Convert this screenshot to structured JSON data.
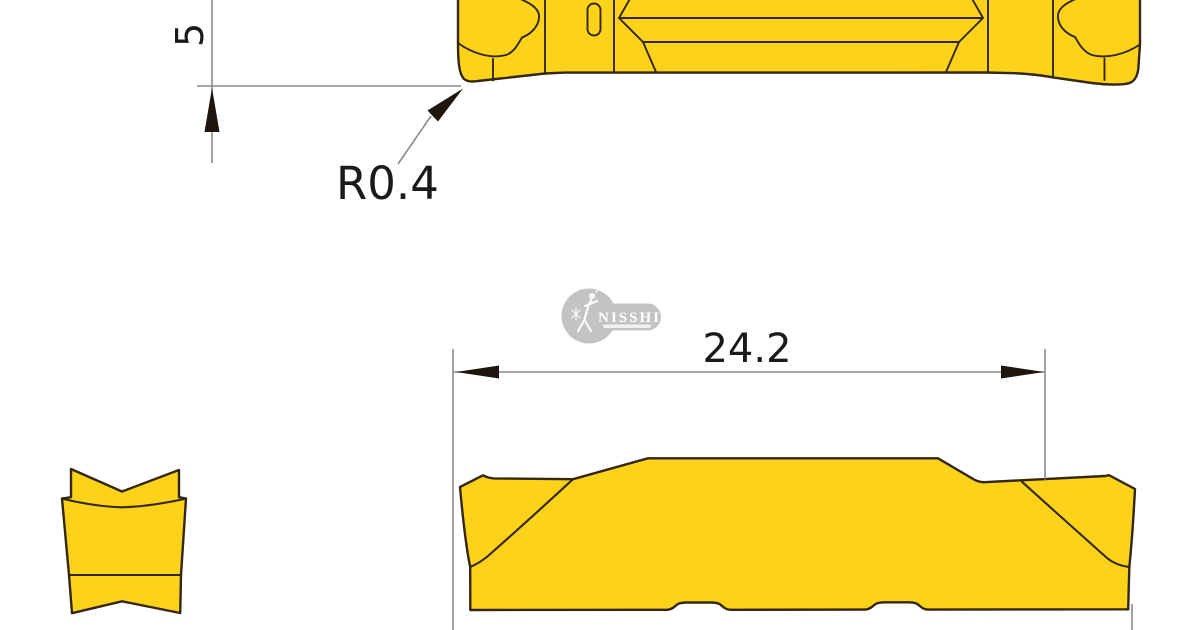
{
  "drawing": {
    "dimensions": {
      "height": "5",
      "corner_radius": "R0.4",
      "length": "24.2"
    }
  },
  "logo": {
    "text": "NISSHIN"
  },
  "colors": {
    "insert_fill": "#fcd21b",
    "insert_outline": "#33270f",
    "dimension_line": "#8b8b8b",
    "dimension_text": "#1a1a1a",
    "arrow": "#1e150d",
    "logo_gray": "#c4c3c2",
    "logo_text": "#ffffff"
  }
}
